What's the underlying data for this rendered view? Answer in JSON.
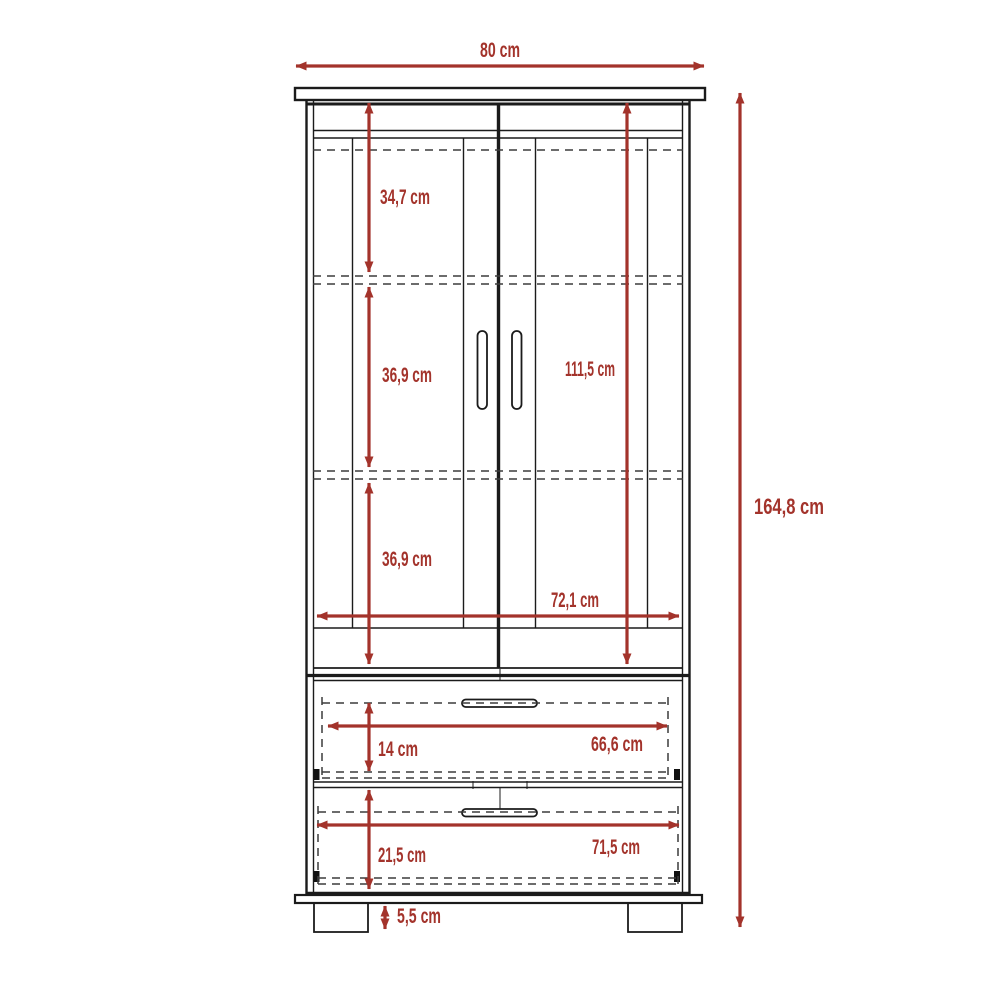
{
  "diagram": {
    "type": "furniture dimension drawing",
    "subject": "two-door wardrobe with two drawers",
    "unit": "cm",
    "colors": {
      "dimension_accent": "#A3332B",
      "outline": "#1b1b1b",
      "hidden_line": "#3c3c3c",
      "background": "#ffffff"
    },
    "dimensions": {
      "overall_width": "80 cm",
      "overall_height": "164,8 cm",
      "top_compartment_height": "34,7 cm",
      "middle_compartment_height": "36,9 cm",
      "bottom_compartment_height": "36,9 cm",
      "door_height": "111,5 cm",
      "interior_width": "72,1 cm",
      "drawer1_height": "14 cm",
      "drawer1_interior_width": "66,6 cm",
      "drawer2_height": "21,5 cm",
      "drawer2_interior_width": "71,5 cm",
      "base_foot_height": "5,5 cm"
    }
  }
}
